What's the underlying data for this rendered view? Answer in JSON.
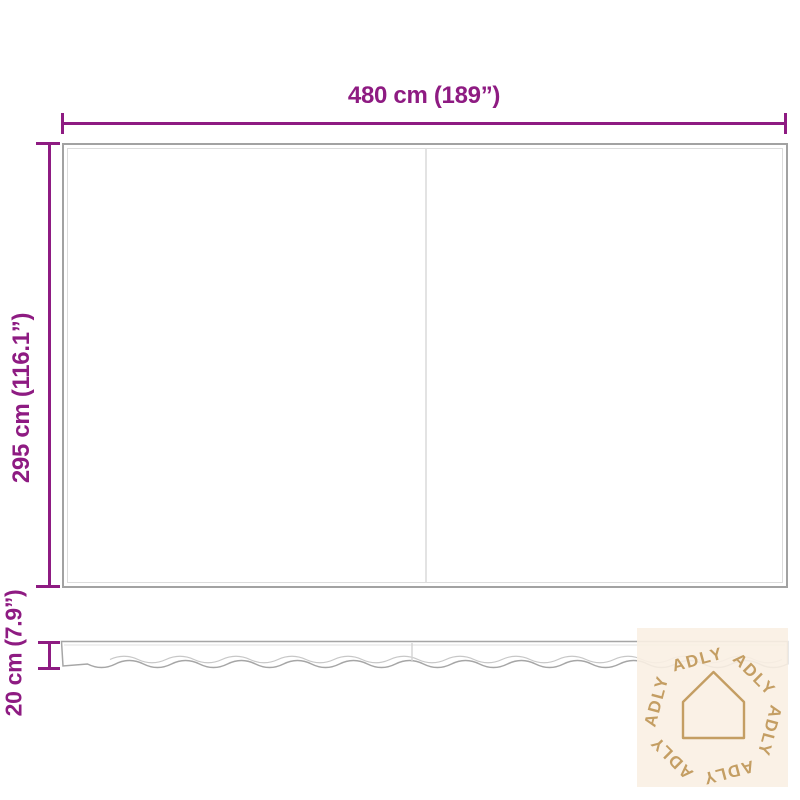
{
  "dimensions": {
    "width_label": "480 cm (189”)",
    "height_label": "295 cm (116.1”)",
    "valance_label": "20 cm (7.9”)"
  },
  "watermark": {
    "brand": "ADLY",
    "icon": "house-outline-icon"
  },
  "colors": {
    "dimension": "#8e1b82",
    "outline": "#a6a6a6",
    "outline_light": "#c7c7c7",
    "watermark_bg": "#faf0e3",
    "watermark_gold": "#c49e63"
  }
}
